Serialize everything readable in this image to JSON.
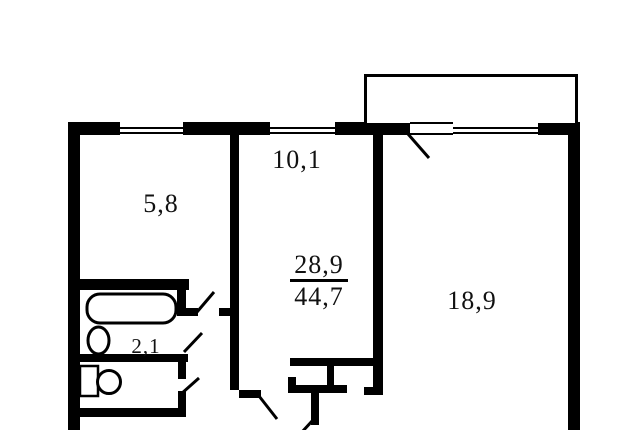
{
  "plan": {
    "title": "apartment floor plan",
    "background_color": "#ffffff",
    "wall_color": "#000000",
    "rooms": [
      {
        "id": "room-5-8",
        "label": "5,8"
      },
      {
        "id": "room-10-1",
        "label": "10,1"
      },
      {
        "id": "room-18-9",
        "label": "18,9"
      },
      {
        "id": "room-2-1",
        "label": "2,1"
      }
    ],
    "area_summary": {
      "living": "28,9",
      "total": "44,7"
    },
    "fixtures": [
      {
        "id": "bathtub"
      },
      {
        "id": "toilet"
      },
      {
        "id": "sink"
      }
    ],
    "features": [
      {
        "id": "balcony"
      },
      {
        "id": "windows",
        "count": 3
      },
      {
        "id": "door-swings",
        "count": 6
      }
    ]
  }
}
